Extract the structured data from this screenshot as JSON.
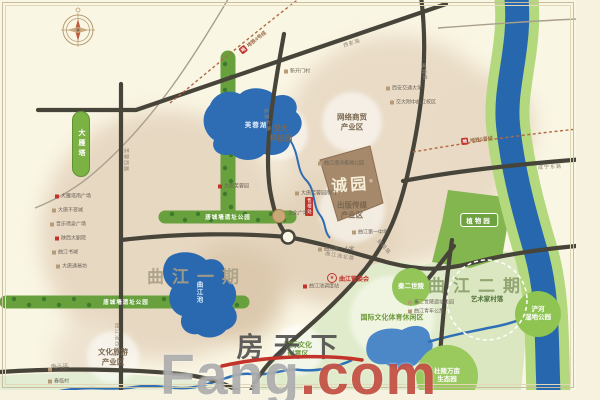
{
  "palette": {
    "accent_red": "#c2342b",
    "river_blue": "#2767ae",
    "park_green": "#67a03c",
    "urban_tan": "#e7d8c2",
    "cream": "#faf6e4"
  },
  "project": {
    "name": "诚园",
    "reg": "®"
  },
  "sales": {
    "text": "售楼处"
  },
  "committee": {
    "star": "★",
    "text": "曲江管委会"
  },
  "pill": {
    "text": "大雁塔"
  },
  "botanic": {
    "text": "植物园"
  },
  "watermark": {
    "cn": "房天下",
    "en_main": "Fang",
    "en_suffix": ".com"
  },
  "area_titles": [
    {
      "text": "曲江一期",
      "x": 197,
      "y": 275,
      "color": "#a89f86"
    },
    {
      "text": "曲江二期",
      "x": 478,
      "y": 284,
      "color": "#8aa06b"
    }
  ],
  "zones": [
    {
      "lines": [
        "交大",
        "科技园"
      ],
      "x": 281,
      "y": 133,
      "r": 27,
      "kind": "white-circle",
      "cls": "zone-brown",
      "fill": "rgba(255,255,255,0.55)"
    },
    {
      "lines": [
        "网络商贸",
        "产业区"
      ],
      "x": 352,
      "y": 122,
      "r": 30,
      "kind": "white-circle",
      "cls": "zone-brown",
      "fill": "rgba(255,255,255,0.55)"
    },
    {
      "lines": [
        "出版传媒",
        "产业区"
      ],
      "x": 352,
      "y": 210,
      "r": 33,
      "kind": "white-circle",
      "cls": "zone-brown",
      "fill": "rgba(255,255,255,0.55)"
    },
    {
      "lines": [
        "国际文化",
        "创意区"
      ],
      "x": 298,
      "y": 350,
      "r": 25,
      "kind": "white-circle",
      "cls": "zone-green",
      "fill": "rgba(255,255,255,0.6)"
    },
    {
      "lines": [
        "国际文化体育休闲区"
      ],
      "x": 392,
      "y": 318,
      "r": 42,
      "kind": "white-circle",
      "cls": "zone-green",
      "fill": "rgba(244,248,233,0.8)"
    },
    {
      "lines": [
        "文化旅游",
        "产业区"
      ],
      "x": 113,
      "y": 357,
      "r": 26,
      "kind": "white-circle",
      "cls": "zone-brown",
      "fill": "rgba(255,255,255,0.55)"
    },
    {
      "lines": [
        "杜陵万亩",
        "生态园"
      ],
      "x": 447,
      "y": 376,
      "r": 31,
      "kind": "green-circle",
      "cls": "zone-white",
      "fill": "#9ac95e"
    },
    {
      "lines": [
        "浐河",
        "湿地公园"
      ],
      "x": 538,
      "y": 314,
      "r": 23,
      "kind": "green-circle",
      "cls": "zone-white",
      "fill": "#8fc452"
    },
    {
      "lines": [
        "秦二世陵"
      ],
      "x": 411,
      "y": 287,
      "r": 19,
      "kind": "green-circle",
      "cls": "zone-white",
      "fill": "#93c558"
    },
    {
      "lines": [
        "艺术家村落"
      ],
      "x": 487,
      "y": 300,
      "r": 40,
      "kind": "dashed-circle",
      "cls": "zone-dash",
      "fill": "none"
    }
  ],
  "park_labels": [
    {
      "text": "唐城墙遗址公园",
      "x": 228,
      "y": 217
    },
    {
      "text": "唐城墙遗址公园",
      "x": 126,
      "y": 302
    }
  ],
  "lake_labels": [
    {
      "text": "芙蓉湖",
      "x": 256,
      "y": 124,
      "vertical": false
    },
    {
      "text": "曲江池",
      "x": 198,
      "y": 292,
      "vertical": true
    }
  ],
  "metro": [
    {
      "chip": "地",
      "text": "地铁4号线",
      "x": 253,
      "y": 42,
      "rot": -38
    },
    {
      "chip": "地",
      "text": "地铁5号线",
      "x": 477,
      "y": 140,
      "rot": -6
    }
  ],
  "road_labels": [
    {
      "text": "西影路",
      "x": 352,
      "y": 43,
      "rot": -17
    },
    {
      "text": "雁翔路",
      "x": 424,
      "y": 72,
      "rot": 83
    },
    {
      "text": "雁翔路",
      "x": 384,
      "y": 247,
      "rot": 48
    },
    {
      "text": "芙蓉东路",
      "x": 267,
      "y": 120,
      "rot": 82
    },
    {
      "text": "芙蓉西路",
      "x": 126,
      "y": 160,
      "rot": 90
    },
    {
      "text": "曲江池西路",
      "x": 117,
      "y": 338,
      "rot": 90
    },
    {
      "text": "曲江池北路",
      "x": 340,
      "y": 256,
      "rot": 10
    },
    {
      "text": "咸宁东路",
      "x": 550,
      "y": 167,
      "rot": -3
    },
    {
      "text": "南三环",
      "x": 60,
      "y": 366,
      "rot": -2
    }
  ],
  "pois": [
    {
      "t": "新开门村",
      "x": 284,
      "y": 71,
      "ic": "tan"
    },
    {
      "t": "西安交通大学",
      "x": 386,
      "y": 88,
      "ic": "tan"
    },
    {
      "t": "交大附中曲江校区",
      "x": 390,
      "y": 102,
      "ic": "tan"
    },
    {
      "t": "大雁塔南广场",
      "x": 55,
      "y": 196,
      "ic": "red"
    },
    {
      "t": "大唐不夜城",
      "x": 52,
      "y": 210,
      "ic": "tan"
    },
    {
      "t": "音乐喷泉广场",
      "x": 50,
      "y": 224,
      "ic": "tan"
    },
    {
      "t": "陕西大剧院",
      "x": 55,
      "y": 238,
      "ic": "red"
    },
    {
      "t": "曲江书城",
      "x": 52,
      "y": 252,
      "ic": "tan"
    },
    {
      "t": "大唐通易坊",
      "x": 56,
      "y": 266,
      "ic": "tan"
    },
    {
      "t": "大唐芙蓉园",
      "x": 218,
      "y": 186,
      "ic": "red"
    },
    {
      "t": "曲江海洋极地公园",
      "x": 318,
      "y": 163,
      "ic": "tan"
    },
    {
      "t": "大唐芙蓉园南门",
      "x": 295,
      "y": 193,
      "ic": "tan"
    },
    {
      "t": "曲江第一小学",
      "x": 318,
      "y": 249,
      "ic": "tan"
    },
    {
      "t": "曲江第一中学",
      "x": 352,
      "y": 232,
      "ic": "tan"
    },
    {
      "t": "文化广场",
      "x": 288,
      "y": 213,
      "ic": "none"
    },
    {
      "t": "秦二世陵遗址公园",
      "x": 408,
      "y": 302,
      "ic": "tan"
    },
    {
      "t": "曲江青年公寓",
      "x": 408,
      "y": 311,
      "ic": "tan"
    },
    {
      "t": "曲江池调度站",
      "x": 303,
      "y": 286,
      "ic": "red"
    },
    {
      "t": "三兆村",
      "x": 48,
      "y": 369,
      "ic": "tan"
    },
    {
      "t": "春临村",
      "x": 48,
      "y": 381,
      "ic": "tan"
    }
  ]
}
